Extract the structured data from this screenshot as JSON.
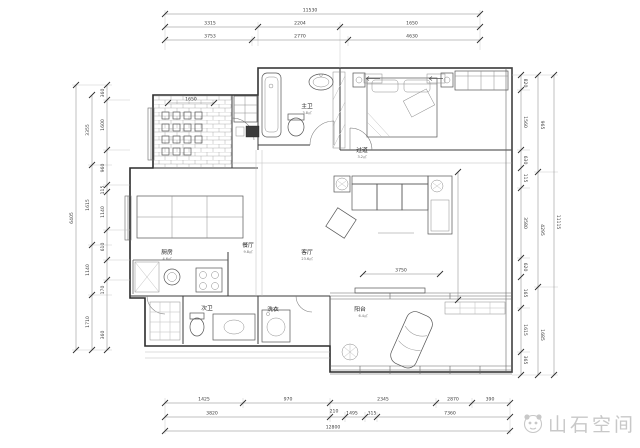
{
  "watermark": {
    "text": "山石空间",
    "logo": "panda-logo"
  },
  "rooms": {
    "kitchen": {
      "label": "厨房",
      "area": "4.6㎡"
    },
    "dining": {
      "label": "餐厅",
      "area": "9.8㎡"
    },
    "living": {
      "label": "客厅",
      "area": "23.6㎡"
    },
    "hallway": {
      "label": "过道",
      "area": "3.2㎡"
    },
    "master_bath": {
      "label": "主卫",
      "area": "3.8㎡"
    },
    "second_bath": {
      "label": "次卫"
    },
    "laundry": {
      "label": "洗衣"
    },
    "balcony": {
      "label": "阳台",
      "area": "6.4㎡"
    }
  },
  "dims": {
    "top": {
      "total": "11530",
      "row1": [
        "3315",
        "2204",
        "1650"
      ],
      "row2": [
        "3753",
        "2770",
        "4630"
      ]
    },
    "bottom": {
      "row1": [
        "1425",
        "970",
        "2345",
        "2870",
        "390"
      ],
      "row2": [
        "3820",
        "210",
        "1495",
        "315",
        "7360"
      ],
      "total": "12800"
    },
    "left": {
      "total": "6405",
      "mid": [
        "3355",
        "1615",
        "1140",
        "1710"
      ],
      "inner": [
        "360",
        "1600",
        "960",
        "115",
        "1140",
        "610",
        "170",
        "360"
      ]
    },
    "right": {
      "total": "11115",
      "mid": [
        "965",
        "4295",
        "1685"
      ],
      "inner": [
        "820",
        "1560",
        "630",
        "115",
        "3580",
        "620",
        "165",
        "1615",
        "365"
      ]
    },
    "interior": [
      "1650",
      "3750"
    ]
  }
}
